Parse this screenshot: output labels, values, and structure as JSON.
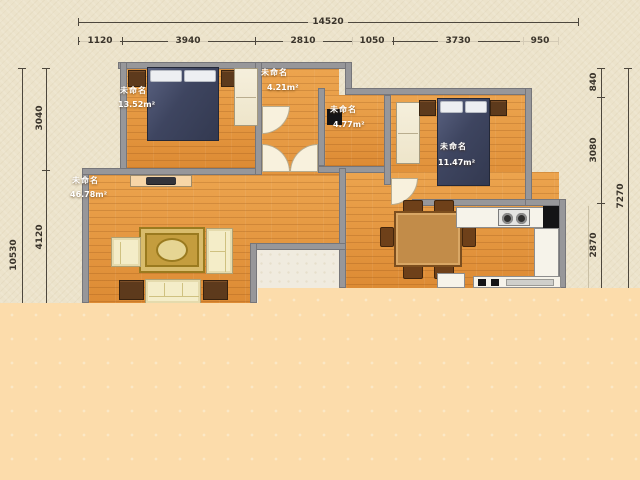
{
  "document": {
    "type": "apartment-floor-plan",
    "bottom_region": "blank (image cut off / not rendered)"
  },
  "rooms": [
    {
      "key": "living-dining",
      "name": "未命名",
      "area": "46.78m²"
    },
    {
      "key": "bedroom-left",
      "name": "未命名",
      "area": "13.52m²"
    },
    {
      "key": "closet-hall",
      "name": "未命名",
      "area": "4.21m²"
    },
    {
      "key": "bathroom",
      "name": "未命名",
      "area": "4.77m²"
    },
    {
      "key": "bedroom-right",
      "name": "未命名",
      "area": "11.47m²"
    }
  ],
  "dimensions": {
    "top_total": "14520",
    "top_segments": [
      "1120",
      "3940",
      "2810",
      "1050",
      "3730",
      "950"
    ],
    "left_total": "10530",
    "left_segments": [
      "3040",
      "4120"
    ],
    "right_total": "7270",
    "right_segments": [
      "840",
      "3080",
      "2870"
    ]
  },
  "furniture_icons": [
    "double-bed",
    "nightstand",
    "wardrobe",
    "tv-console",
    "tv",
    "rug",
    "armchair",
    "loveseat",
    "sofa",
    "side-table",
    "dining-table",
    "dining-chair",
    "cooktop",
    "kitchen-sink",
    "kitchen-counter",
    "washer"
  ],
  "colors": {
    "background": "#ece3cb",
    "cutoff_fill": "#fcdcab",
    "floor": "#e0913f",
    "wall": "#97979a",
    "bed": "#3e4560",
    "wood_dark": "#5d3a1c",
    "dining_wood": "#c28c49",
    "label_text": "#ffffff",
    "dimension_text": "#3a342b"
  }
}
